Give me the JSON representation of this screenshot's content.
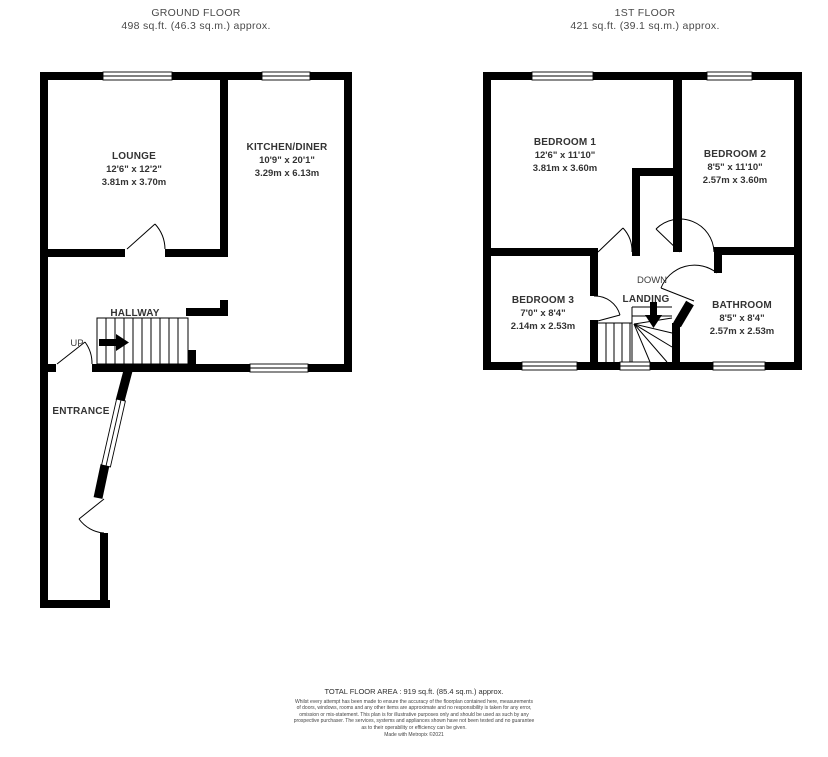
{
  "colors": {
    "wall": "#000000",
    "text": "#333333",
    "background": "#ffffff"
  },
  "ground_floor": {
    "title": "GROUND FLOOR",
    "area": "498 sq.ft. (46.3 sq.m.) approx.",
    "rooms": {
      "lounge": {
        "name": "LOUNGE",
        "imperial": "12'6\" x 12'2\"",
        "metric": "3.81m x 3.70m"
      },
      "kitchen": {
        "name": "KITCHEN/DINER",
        "imperial": "10'9\" x 20'1\"",
        "metric": "3.29m x 6.13m"
      },
      "hallway": {
        "name": "HALLWAY"
      },
      "entrance": {
        "name": "ENTRANCE"
      }
    },
    "stairs_direction": "UP"
  },
  "first_floor": {
    "title": "1ST FLOOR",
    "area": "421 sq.ft. (39.1 sq.m.) approx.",
    "rooms": {
      "bedroom1": {
        "name": "BEDROOM 1",
        "imperial": "12'6\" x 11'10\"",
        "metric": "3.81m x 3.60m"
      },
      "bedroom2": {
        "name": "BEDROOM 2",
        "imperial": "8'5\" x 11'10\"",
        "metric": "2.57m x 3.60m"
      },
      "bedroom3": {
        "name": "BEDROOM 3",
        "imperial": "7'0\" x 8'4\"",
        "metric": "2.14m x 2.53m"
      },
      "bathroom": {
        "name": "BATHROOM",
        "imperial": "8'5\" x 8'4\"",
        "metric": "2.57m x 2.53m"
      },
      "landing": {
        "name": "LANDING"
      }
    },
    "stairs_direction": "DOWN"
  },
  "footer": {
    "total_area": "TOTAL FLOOR AREA : 919 sq.ft. (85.4 sq.m.) approx.",
    "disclaimer_lines": [
      "Whilst every attempt has been made to ensure the accuracy of the floorplan contained here, measurements",
      "of doors, windows, rooms and any other items are approximate and no responsibility is taken for any error,",
      "omission or mis-statement. This plan is for illustrative purposes only and should be used as such by any",
      "prospective purchaser. The services, systems and appliances shown have not been tested and no guarantee",
      "as to their operability or efficiency can be given."
    ],
    "credit": "Made with Metropix ©2021"
  }
}
